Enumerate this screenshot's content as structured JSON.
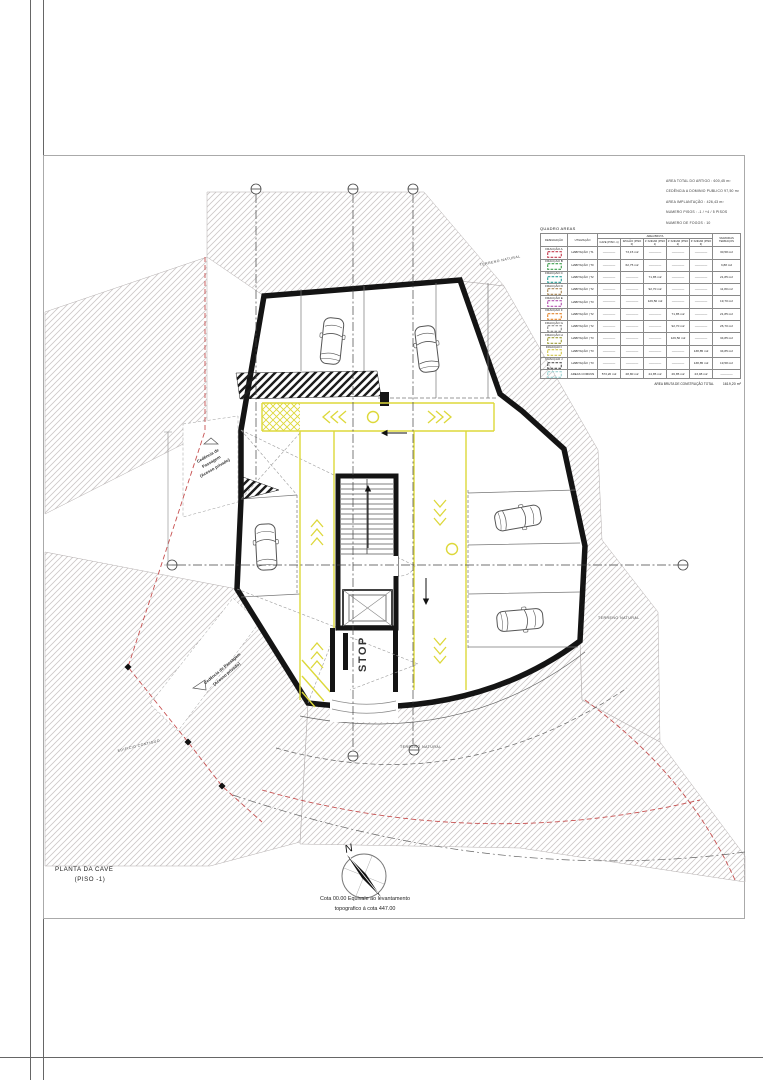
{
  "colors": {
    "wall_black": "#141414",
    "lane_yellow": "#ddd83a",
    "property_red": "#c75050",
    "hatch_gray": "#ccc7c7"
  },
  "info_block": {
    "lines": [
      "AREA TOTAL DO ARTIGO : 600,45 m²",
      "CEDÊNCIA A DOMINIO PUBLICO 97,50 m²",
      "AREA IMPLANTAÇÃO : 426,43 m²",
      "NUMERO PISOS : -1 / +4 / 5 PISOS",
      "NUMERO DE FOGOS : 10"
    ]
  },
  "areas_table": {
    "title": "QUADRO AREAS",
    "headers": {
      "designacao": "DESIGNAÇÃO",
      "utilizacao": "UTILIZAÇÃO",
      "area_bruta": "AREA BRUTA",
      "varandas": "VARANDAS TERRAÇOS"
    },
    "floors": [
      "CAVE (PISO -1)",
      "R/CHÃO (PISO 0)",
      "1º ANDAR (PISO 1)",
      "2º ANDAR (PISO 2)",
      "3º ANDAR (PISO 3)"
    ],
    "rows": [
      {
        "label": "FRACÇÃO A",
        "color": "#c43b4e",
        "use": "HABITAÇÃO | T1",
        "cave": "————",
        "rchao": "73,15 m2",
        "a1": "————",
        "a2": "————",
        "a3": "————",
        "var": "30,58 m2"
      },
      {
        "label": "FRACÇÃO B",
        "color": "#3f9e4d",
        "use": "HABITAÇÃO | T0",
        "cave": "————",
        "rchao": "62,75 m2",
        "a1": "————",
        "a2": "————",
        "a3": "————",
        "var": "3,88 m2"
      },
      {
        "label": "FRACÇÃO C",
        "color": "#2fa39b",
        "use": "HABITAÇÃO | T2",
        "cave": "————",
        "rchao": "————",
        "a1": "71,85 m2",
        "a2": "————",
        "a3": "————",
        "var": "21,85 m2"
      },
      {
        "label": "FRACÇÃO D",
        "color": "#a98858",
        "use": "HABITAÇÃO | T2",
        "cave": "————",
        "rchao": "————",
        "a1": "92,70 m2",
        "a2": "————",
        "a3": "————",
        "var": "11,80 m2"
      },
      {
        "label": "FRACÇÃO E",
        "color": "#b455b0",
        "use": "HABITAÇÃO | T3",
        "cave": "————",
        "rchao": "————",
        "a1": "129,50 m2",
        "a2": "————",
        "a3": "————",
        "var": "19,70 m2"
      },
      {
        "label": "FRACÇÃO F",
        "color": "#e2862f",
        "use": "HABITAÇÃO | T2",
        "cave": "————",
        "rchao": "————",
        "a1": "————",
        "a2": "71,85 m2",
        "a3": "————",
        "var": "21,85 m2"
      },
      {
        "label": "FRACÇÃO G",
        "color": "#8f8f8f",
        "use": "HABITAÇÃO | T2",
        "cave": "————",
        "rchao": "————",
        "a1": "————",
        "a2": "92,70 m2",
        "a3": "————",
        "var": "26,70 m2"
      },
      {
        "label": "FRACÇÃO H",
        "color": "#9d9d3a",
        "use": "HABITAÇÃO | T3",
        "cave": "————",
        "rchao": "————",
        "a1": "————",
        "a2": "129,50 m2",
        "a3": "————",
        "var": "34,85 m2"
      },
      {
        "label": "FRACÇÃO I",
        "color": "#cfc44a",
        "use": "HABITAÇÃO | T3",
        "cave": "————",
        "rchao": "————",
        "a1": "————",
        "a2": "————",
        "a3": "138,85 m2",
        "var": "34,85 m2"
      },
      {
        "label": "FRACÇÃO J",
        "color": "#565656",
        "use": "HABITAÇÃO | T3",
        "cave": "————",
        "rchao": "————",
        "a1": "————",
        "a2": "————",
        "a3": "138,85 m2",
        "var": "19,58 m2"
      },
      {
        "label": "",
        "color": "#9fd4d4",
        "use": "AREAS COMUNS",
        "cave": "573,20 m2",
        "rchao": "28,80 m2",
        "a1": "24,85 m2",
        "a2": "26,85 m2",
        "a3": "23,08 m2",
        "var": "————"
      }
    ],
    "total_label": "AREA BRUTA DE CONSTRUÇÃO TOTAL",
    "total_value": "1619,20 m²"
  },
  "plan": {
    "terreno_natural": "TERRENO NATURAL",
    "cedencia_line1": "Cedência de",
    "cedencia_line2": "Passagem",
    "cedencia_line3": "(Acesso privado)",
    "cedencia2_line1": "Cedência de Passagem",
    "cedencia2_line2": "(Acesso privado)",
    "edificio_contiguo": "EDIFICIO CONTIGUO",
    "stop": "STOP"
  },
  "compass": {
    "north": "N"
  },
  "title_block": {
    "line1": "PLANTA DA CAVE",
    "line2": "(PISO -1)"
  },
  "footnote": {
    "line1": "Cota 00.00 Equivale ao levantamento",
    "line2": "topografico á cota 447.00"
  }
}
